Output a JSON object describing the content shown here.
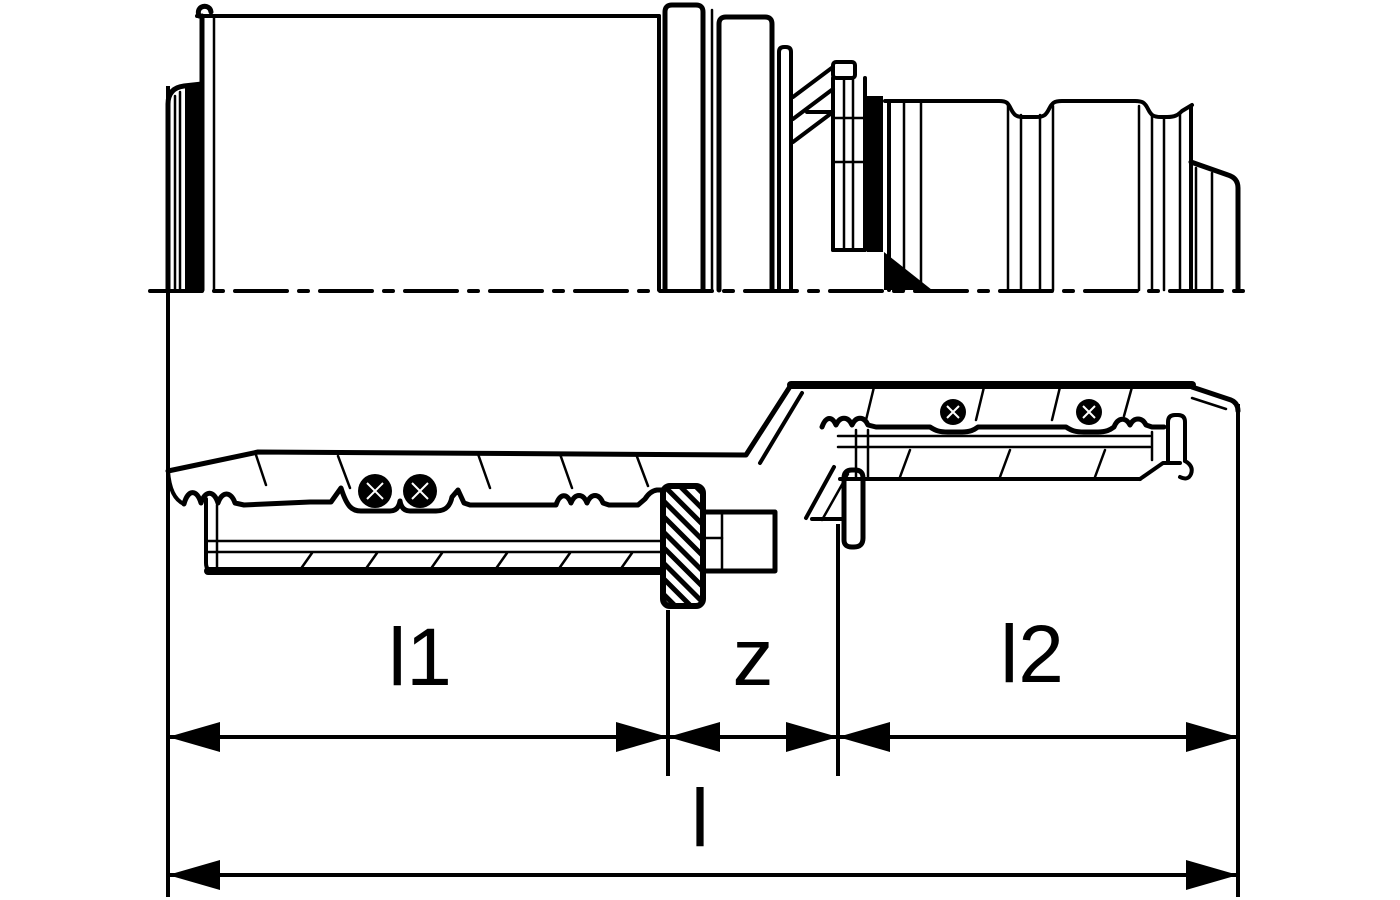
{
  "drawing": {
    "background_color": "#ffffff",
    "line_color": "#000000",
    "dimension_labels": {
      "l1": "l1",
      "z": "z",
      "l2": "l2",
      "l": "l"
    }
  }
}
